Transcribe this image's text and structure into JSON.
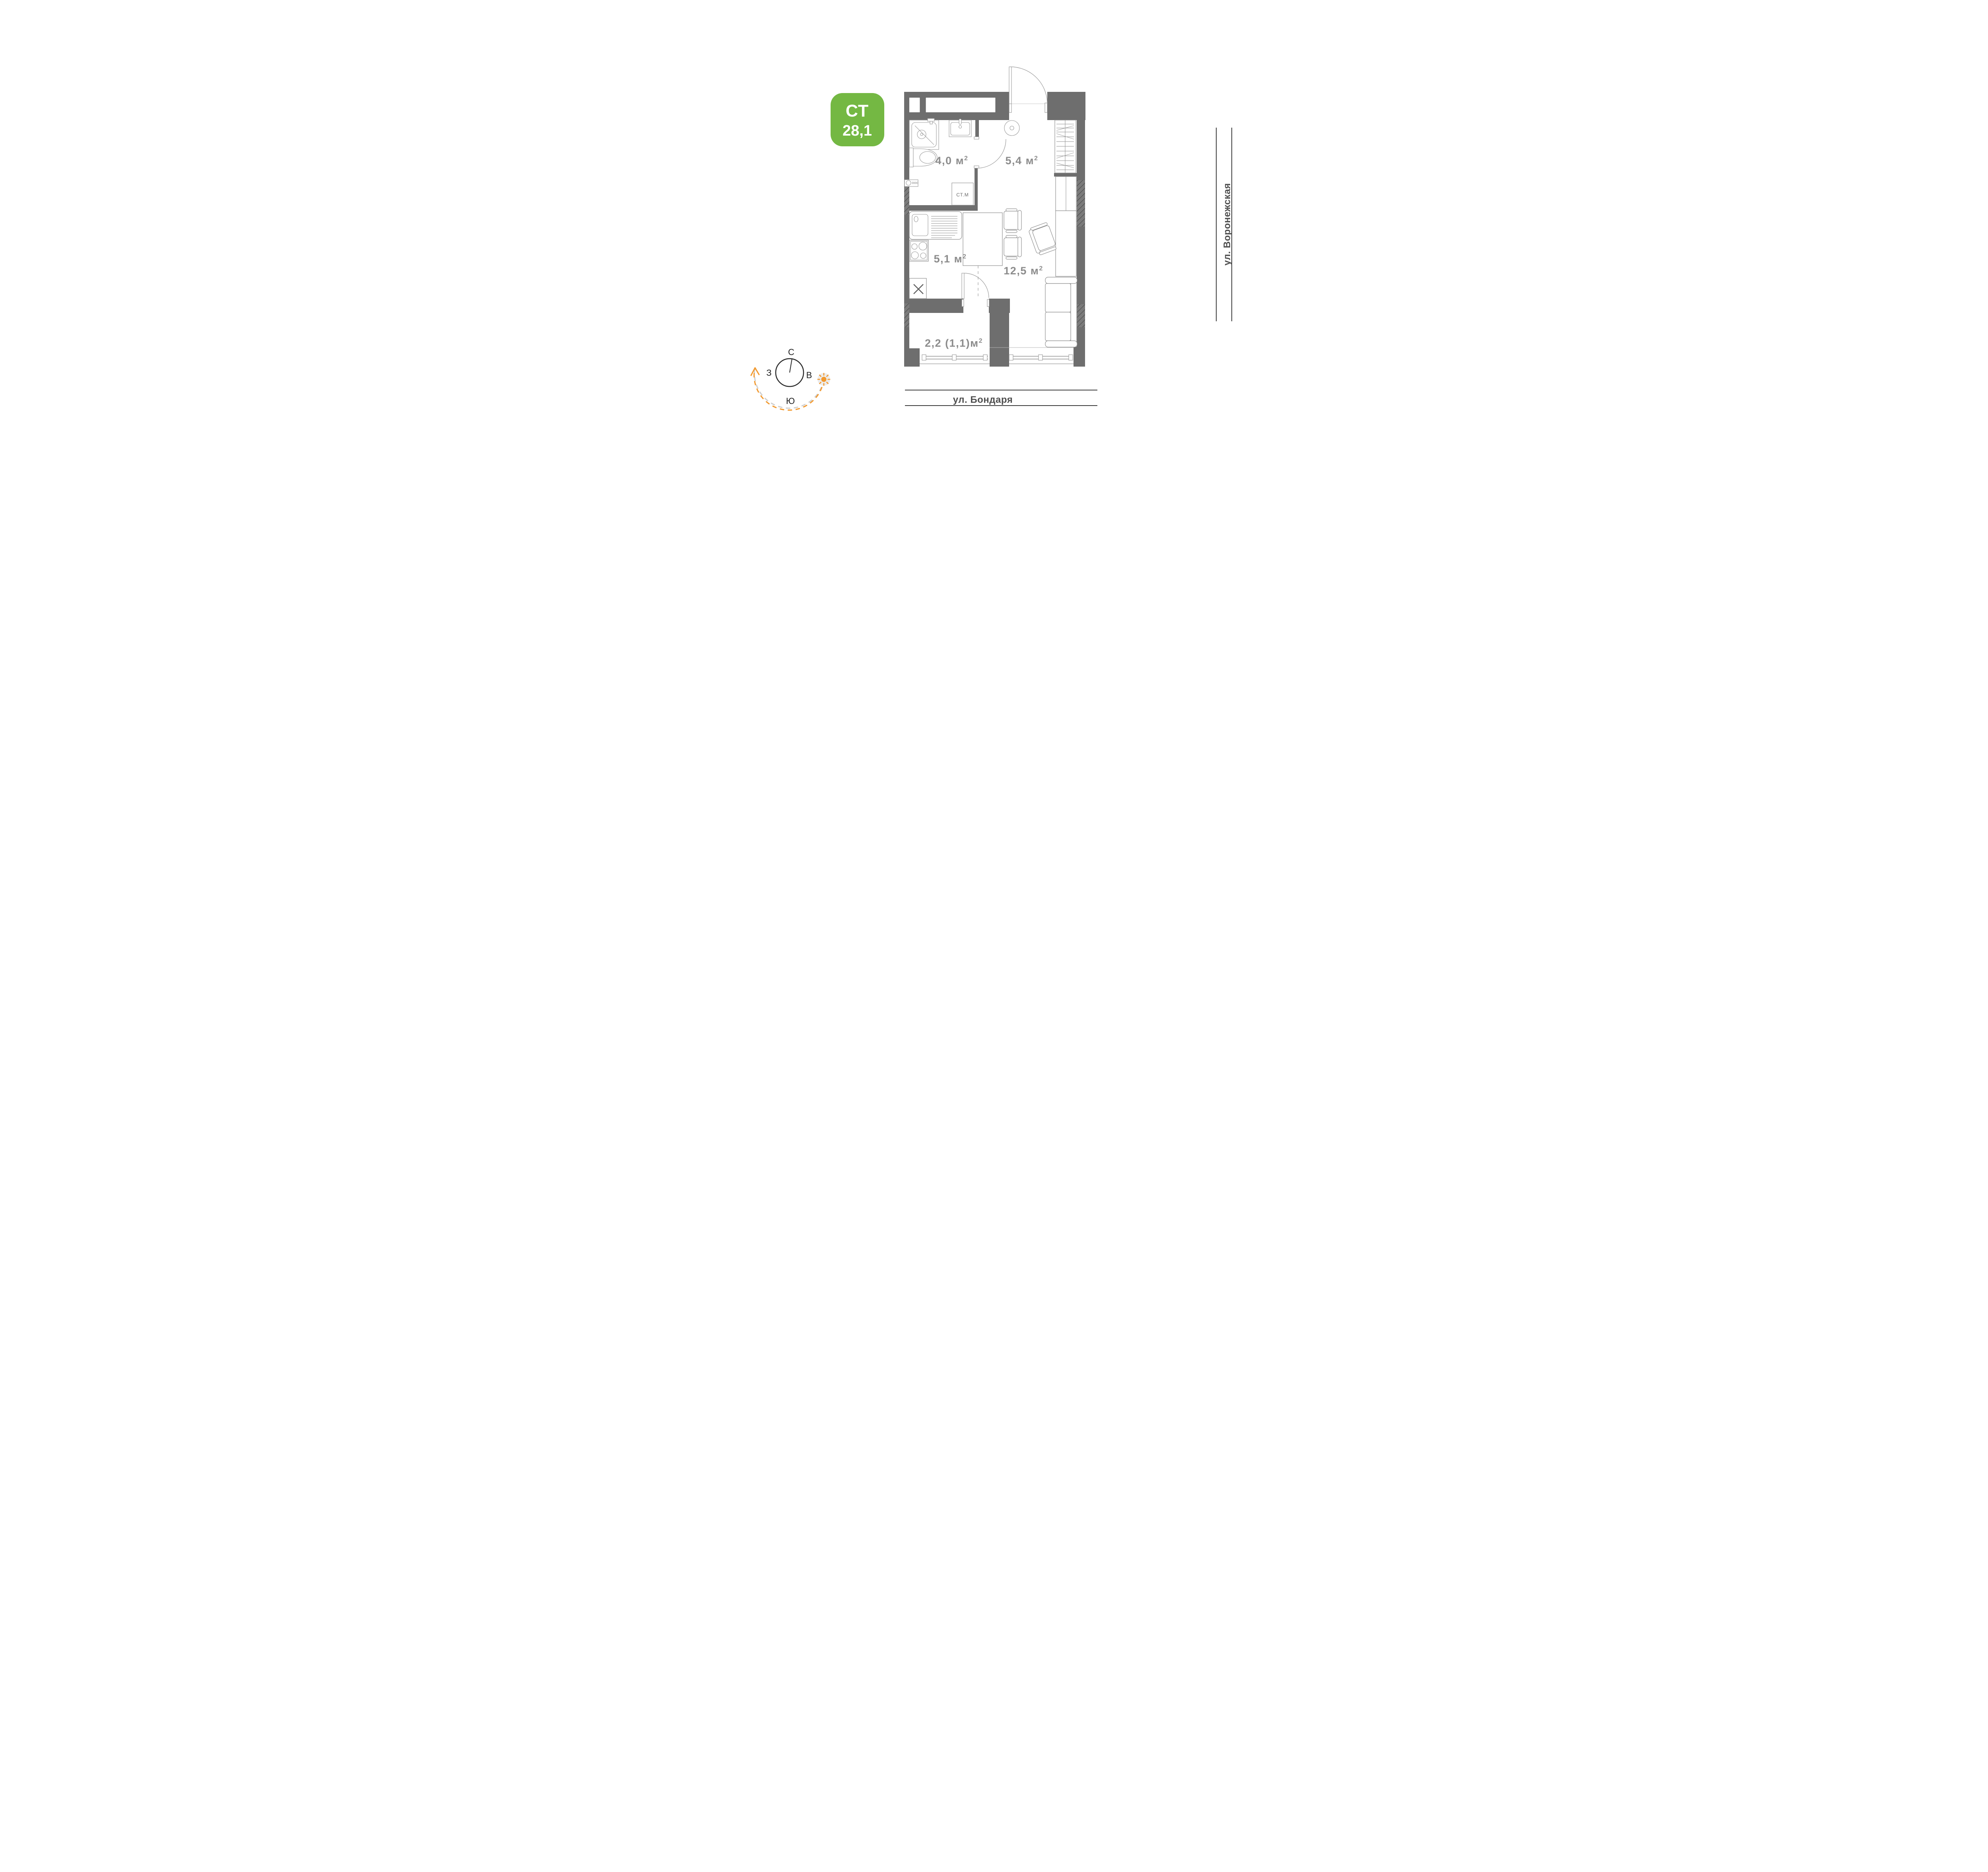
{
  "badge": {
    "type_label": "СТ",
    "area_value": "28,1"
  },
  "plan": {
    "rooms": [
      {
        "id": "bathroom",
        "area": "4,0 м",
        "sup": "2"
      },
      {
        "id": "hallway",
        "area": "5,4 м",
        "sup": "2"
      },
      {
        "id": "kitchen",
        "area": "5,1 м",
        "sup": "2"
      },
      {
        "id": "living-room",
        "area": "12,5 м",
        "sup": "2"
      },
      {
        "id": "balcony",
        "area": "2,2 (1,1)м",
        "sup": "2"
      }
    ],
    "washing_machine_label": "СТ.М"
  },
  "compass": {
    "north": "С",
    "east": "В",
    "south": "Ю",
    "west": "З"
  },
  "streets": {
    "bottom": "ул. Бондаря",
    "right": "ул. Воронежская"
  },
  "colors": {
    "badge_green": "#74b843",
    "wall_gray": "#6e6e6e",
    "sun_orange": "#f2992e",
    "label_gray": "#8c8c8c"
  }
}
